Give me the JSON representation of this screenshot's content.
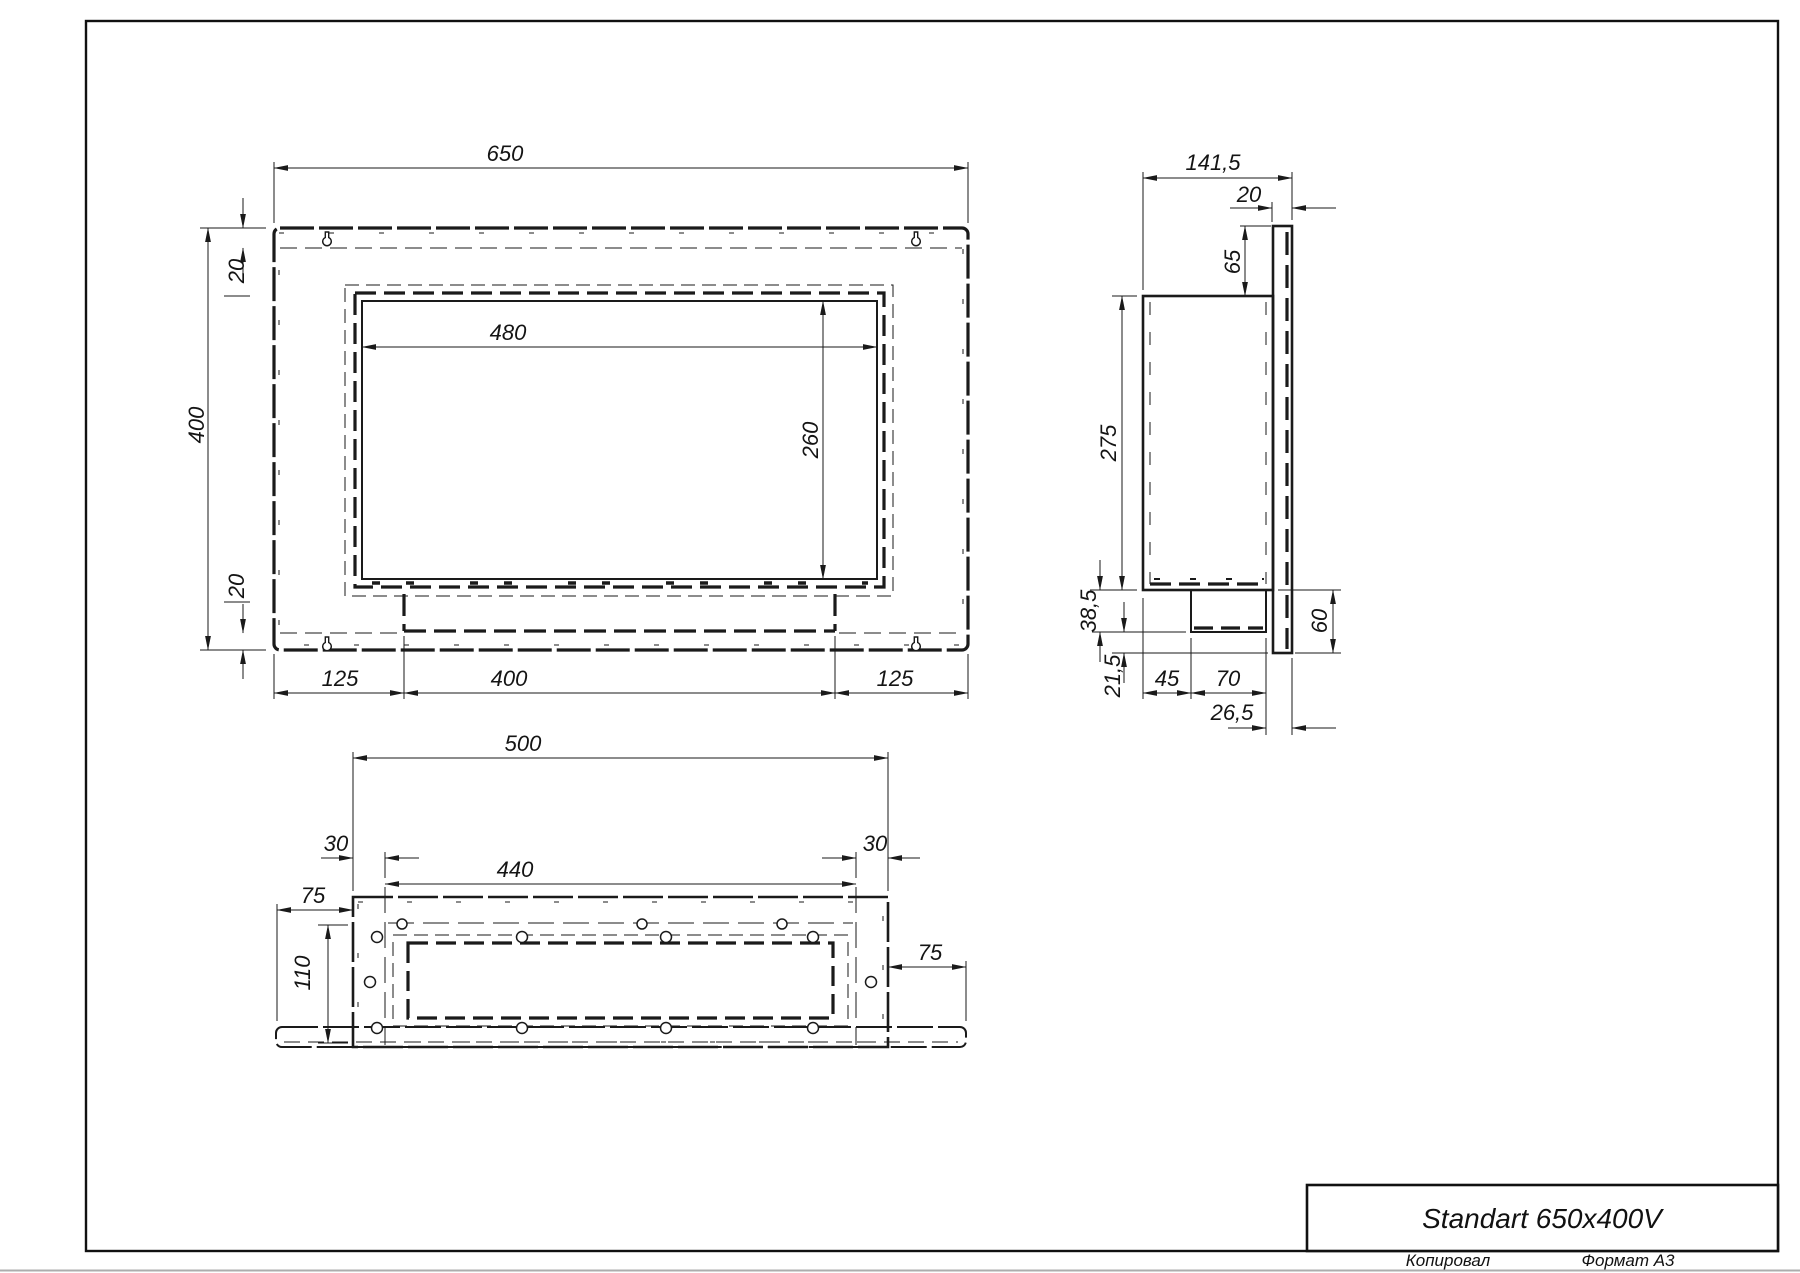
{
  "drawing": {
    "title": "Standart 650x400V",
    "footer": {
      "copied": "Копировал",
      "format": "Формат А3"
    }
  },
  "front_view": {
    "dims": {
      "overall_width": "650",
      "overall_height": "400",
      "top_margin": "20",
      "bottom_margin": "20",
      "opening_width": "480",
      "opening_height": "260",
      "bottom_left_offset": "125",
      "bottom_opening_width": "400",
      "bottom_right_offset": "125"
    }
  },
  "side_view": {
    "dims": {
      "overall_depth": "141,5",
      "flange_thickness": "20",
      "flange_above_top": "65",
      "body_height": "275",
      "tray_drop": "38,5",
      "flange_below_tray": "21,5",
      "tray_offset": "45",
      "tray_width": "70",
      "tray_to_back": "26,5",
      "flange_below_body": "60"
    }
  },
  "bottom_view": {
    "dims": {
      "body_width": "500",
      "left_inset": "30",
      "opening_width": "440",
      "right_inset": "30",
      "flange_left_overhang": "75",
      "depth": "110",
      "flange_right_overhang": "75"
    }
  }
}
